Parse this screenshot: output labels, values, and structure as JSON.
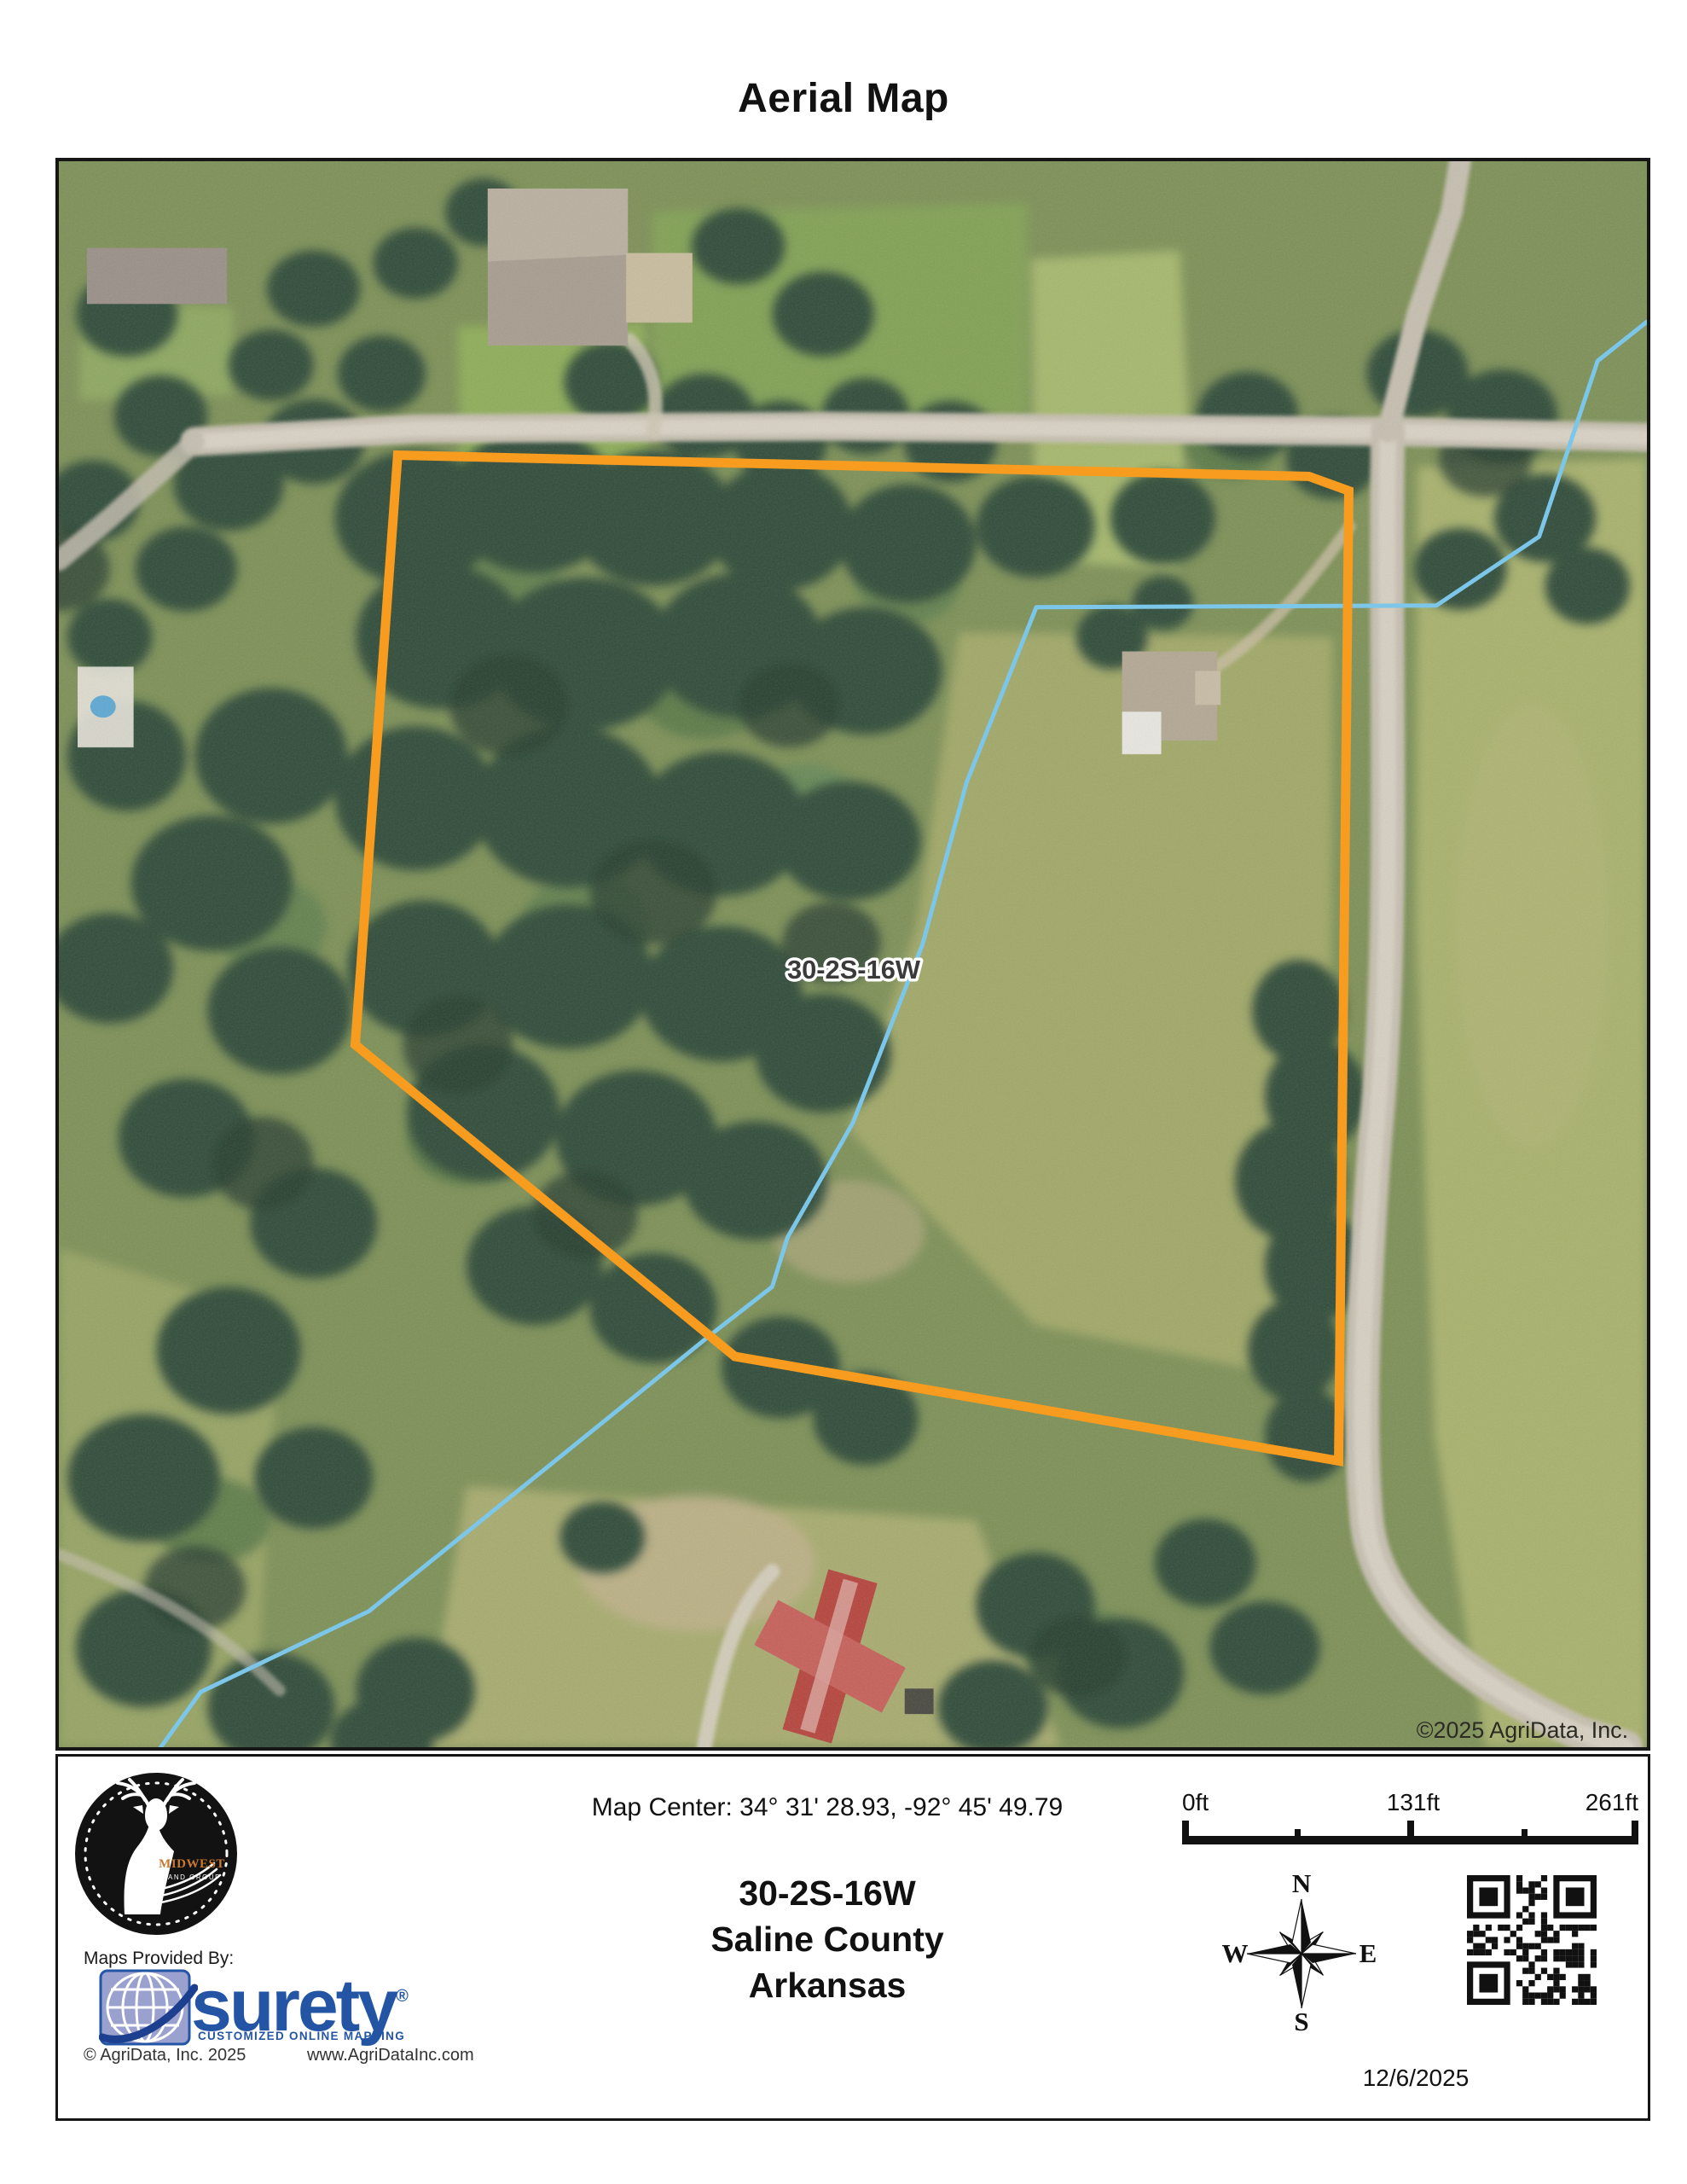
{
  "page": {
    "title": "Aerial Map"
  },
  "map": {
    "parcel_label": "30-2S-16W",
    "copyright_overlay": "©2025 AgriData, Inc.",
    "parcel_color": "#F79C1E",
    "stream_color": "#7CC6EA"
  },
  "footer": {
    "map_center": "Map Center: 34° 31' 28.93,  -92° 45' 49.79",
    "plss": "30-2S-16W",
    "county": "Saline County",
    "state": "Arkansas",
    "date": "12/6/2025",
    "provided_by": "Maps Provided By:",
    "logo": {
      "brand": "MIDWEST",
      "sub": "LAND GROUP"
    },
    "surety": {
      "name": "surety",
      "reg": "®",
      "tagline": "CUSTOMIZED ONLINE MAPPING",
      "copyright": "© AgriData, Inc. 2025",
      "url": "www.AgriDataInc.com",
      "blue": "#2355A4"
    },
    "scalebar": {
      "start": "0ft",
      "mid": "131ft",
      "end": "261ft"
    },
    "compass": {
      "n": "N",
      "s": "S",
      "e": "E",
      "w": "W"
    }
  }
}
